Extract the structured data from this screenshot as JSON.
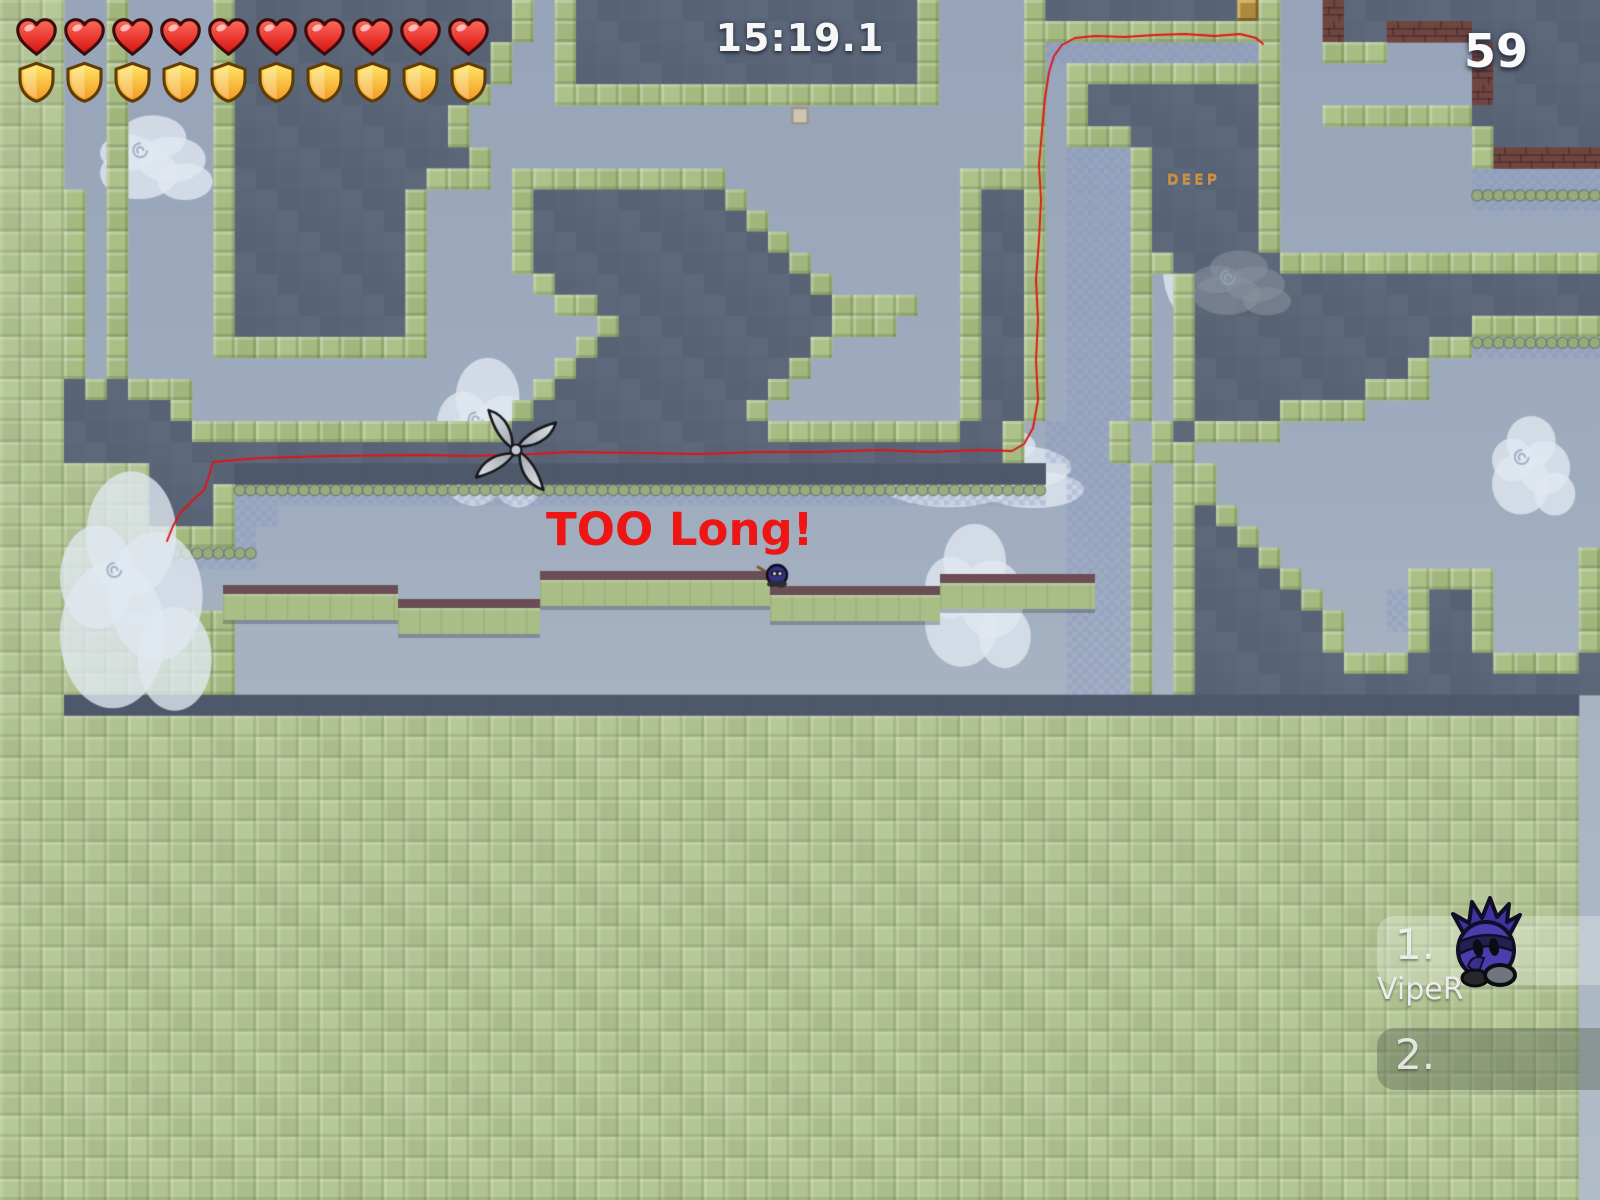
{
  "hud": {
    "timer": "15:19.1",
    "counter": "59",
    "hearts": 10,
    "shields": 10
  },
  "messages": {
    "too_long": "TOO Long!",
    "deep": "DEEP"
  },
  "leaderboard": {
    "entries": [
      {
        "rank": "1.",
        "name": "VipeR"
      },
      {
        "rank": "2.",
        "name": ""
      }
    ]
  },
  "colors": {
    "sky_top": "#97a4b9",
    "sky_bottom": "#b1bcc8",
    "slate": "#596476",
    "navy_band": "#4e586b",
    "green_wall": "#a7bc83",
    "green_field": "#b4c394",
    "freeze": "#8090c6",
    "brick": "#6f4540",
    "gold_tile": "#ab8a40",
    "race_line": "#e11414",
    "map_text_red": "#ee1515",
    "map_text_orange": "#cd9040"
  },
  "map": {
    "cols": 75,
    "rows": 57,
    "grid": [
      "GGG..S....SSSSSSSSSSSSSSS.SSSSSSSSSSSSSSSSSS....GSSSSSSSSSDG..BBBBBBBBBBBBB",
      "GGG..S....SSSSSSSSSSSSSSS.SSSSSSSSSSSSSSSSSS....GSSSSSSSSSSG..BBBBBBBBBBBBB",
      "GGG..S....SSSSSSSSSSSSSS..SSSSSSSSSSSSSSSSSS....GFFFFFFFFFFG..GGG....BBBBBB",
      "GGG..S....SSSSSSSSSSSSSS..SSSSSSSSSSSSSSSSSS....G.SSSSSSSSSS.........BBBBBB",
      "GGG..S....SSSSSSSSSSSSS...SSSSSSSSSSSSSSSSSS....G.SSSSSSSSSS.........BBBBBB",
      "GGG..S....SSSSSSSSSSSS...............w..........G.SSSSSSSSSS..GGGGGGGBBBBBB",
      "GGG..S....SSSSSSSSSSSS..........................G.SSSSSSSSSS.........GBBBBB",
      "GGG..S....SSSSSSSSSSSSS.........................G.FFFSSSSSSS.........GBBBBB",
      "GGG..S....SSSSSSSSSSSSS.SSSSSSSSSS...........SSSG.FFFSSSSSSS.........FFFFFF",
      "GGGS.S....SSSSSSSSSS....SSSSSSSSSSS..........SSSS.FFFSSSSSSS.........ffffff",
      "GGGS.S....SSSSSSSSSS....SSSSSSSSSSSS.........SSSS.FFFSSSSSSS...............",
      "GGGS.S....SSSSSSSSSS....SSSSSSSSSSSSS........SSSS.FFFSSSSSSS...............",
      "GGGS.S....SSSSSSSSSS....SSSSSSSSSSSSSS.......SSSS.FFFSSSSSSSSSSSSSSSSSSSSSS",
      "GGGS.S....SSSSSSSSSS.....SSSSSSSSSSSSSS......SSSS.FFFS.SSSSSSSSSSSSSSSSSSSS",
      "GGGS.S....SSSSSSSSSS......SSSSSSSSSSSSSSSSS..SSSS.FFFS.SSSSSSSSSSSSSSSSSSSS",
      "GGGS.S....SSSSSSSSSS........SSSSSSSSSSSSSS...SSSS.FFFS.SSSSSSSSSSSSSSSSSSSS",
      "GGGS.S....SSSSSSSSSS.......SSSSSSSSSSSS......SSSS.FFFS.SSSSSSSSSSSSSSffffff",
      "GGGS.S....................SSSSSSSSSSSS.......SSSS.FFFS.SSSSSSSSSSSS........",
      "GGGSSSSSS................SSSSSSSSSSSS........SSSS.FFFS.SSSSSSSSSSSS........",
      "GGGSSSSSS...............SSSSSSSSSSSS.........SSSS.FFFS.SSSSSSSSS...........",
      "GGGSSSSSSSSSSSSSSSSSSSSSSSSSSSSSSSSSSSSSSSSSSSSS.FFFS.SSSSSS..............",
      "GGGSSSSSSSSSSSSSSSSSSSSSSSSSSSSSSSSSSSSSSSSSSSSS.FFFS.SS..................",
      "GGGGGGGSSSSNNNNNNNNNNNNNNNNNNNNNNNNNNNNNNNNNNNNNN.FFFS.SS..................",
      "GGGGGGGSSSSffffffffffffffffffffffffffffffffffffff.FFFS.SS..................",
      "GGGGGGGSSSSFF.....................................FFFS.SSS.................",
      "GGGGGGGSSSSF......................................FFFS.SSSS................",
      "GGGGGGG.ffff......................................FFFS.SSSSS..............S",
      "GGGGGGG...........................................FFFS.SSSSSS.....SSSS....S",
      "GGGGGGG...........................................FFFS.SSSSSSS...FSSSS....S",
      "GGGGGGGGGGG.......................................FFFS.SSSSSSSS..FSSSS....S",
      "GGGGGGGGGGG.......................................FFFS.SSSSSSSS...SSSS....S",
      "GGGGGGGGGGG.......................................FFFS.SSSSSSSSSSSSSSSSSSSS",
      "GGGGGGGGGGG.......................................FFFS.SSSSSSSSSSSSSSSSSSSS",
      "GGGNNNNNNNNNNNNNNNNNNNNNNNNNNNNNNNNNNNNNNNNNNNNNNNNNNNNNNNNNNNNNNNNNNNNNNN",
      "GGGGGGGGGGGGGGGGGGGGGGGGGGGGGGGGGGGGGGGGGGGGGGGGGGGGGGGGGGGGGGGGGGGGGGGGGG",
      "GGGGGGGGGGGGGGGGGGGGGGGGGGGGGGGGGGGGGGGGGGGGGGGGGGGGGGGGGGGGGGGGGGGGGGGGGG",
      "GGGGGGGGGGGGGGGGGGGGGGGGGGGGGGGGGGGGGGGGGGGGGGGGGGGGGGGGGGGGGGGGGGGGGGGGGG",
      "GGGGGGGGGGGGGGGGGGGGGGGGGGGGGGGGGGGGGGGGGGGGGGGGGGGGGGGGGGGGGGGGGGGGGGGGGG",
      "GGGGGGGGGGGGGGGGGGGGGGGGGGGGGGGGGGGGGGGGGGGGGGGGGGGGGGGGGGGGGGGGGGGGGGGGGG",
      "GGGGGGGGGGGGGGGGGGGGGGGGGGGGGGGGGGGGGGGGGGGGGGGGGGGGGGGGGGGGGGGGGGGGGGGGGG",
      "GGGGGGGGGGGGGGGGGGGGGGGGGGGGGGGGGGGGGGGGGGGGGGGGGGGGGGGGGGGGGGGGGGGGGGGGGG",
      "GGGGGGGGGGGGGGGGGGGGGGGGGGGGGGGGGGGGGGGGGGGGGGGGGGGGGGGGGGGGGGGGGGGGGGGGGG",
      "GGGGGGGGGGGGGGGGGGGGGGGGGGGGGGGGGGGGGGGGGGGGGGGGGGGGGGGGGGGGGGGGGGGGGGGGGG",
      "GGGGGGGGGGGGGGGGGGGGGGGGGGGGGGGGGGGGGGGGGGGGGGGGGGGGGGGGGGGGGGGGGGGGGGGGGG",
      "GGGGGGGGGGGGGGGGGGGGGGGGGGGGGGGGGGGGGGGGGGGGGGGGGGGGGGGGGGGGGGGGGGGGGGGGGG",
      "GGGGGGGGGGGGGGGGGGGGGGGGGGGGGGGGGGGGGGGGGGGGGGGGGGGGGGGGGGGGGGGGGGGGGGGGGG",
      "GGGGGGGGGGGGGGGGGGGGGGGGGGGGGGGGGGGGGGGGGGGGGGGGGGGGGGGGGGGGGGGGGGGGGGGGGG",
      "GGGGGGGGGGGGGGGGGGGGGGGGGGGGGGGGGGGGGGGGGGGGGGGGGGGGGGGGGGGGGGGGGGGGGGGGGG",
      "GGGGGGGGGGGGGGGGGGGGGGGGGGGGGGGGGGGGGGGGGGGGGGGGGGGGGGGGGGGGGGGGGGGGGGGGGG",
      "GGGGGGGGGGGGGGGGGGGGGGGGGGGGGGGGGGGGGGGGGGGGGGGGGGGGGGGGGGGGGGGGGGGGGGGGGG",
      "GGGGGGGGGGGGGGGGGGGGGGGGGGGGGGGGGGGGGGGGGGGGGGGGGGGGGGGGGGGGGGGGGGGGGGGGGG",
      "GGGGGGGGGGGGGGGGGGGGGGGGGGGGGGGGGGGGGGGGGGGGGGGGGGGGGGGGGGGGGGGGGGGGGGGGGG",
      "GGGGGGGGGGGGGGGGGGGGGGGGGGGGGGGGGGGGGGGGGGGGGGGGGGGGGGGGGGGGGGGGGGGGGGGGGG",
      "GGGGGGGGGGGGGGGGGGGGGGGGGGGGGGGGGGGGGGGGGGGGGGGGGGGGGGGGGGGGGGGGGGGGGGGGGG",
      "GGGGGGGGGGGGGGGGGGGGGGGGGGGGGGGGGGGGGGGGGGGGGGGGGGGGGGGGGGGGGGGGGGGGGGGGGG",
      "GGGGGGGGGGGGGGGGGGGGGGGGGGGGGGGGGGGGGGGGGGGGGGGGGGGGGGGGGGGGGGGGGGGGGGGGGG",
      "GGGGGGGGGGGGGGGGGGGGGGGGGGGGGGGGGGGGGGGGGGGGGGGGGGGGGGGGGGGGGGGGGGGGGGGGGG"
    ],
    "platform_segments": [
      {
        "x": 223,
        "w": 175,
        "top": 585
      },
      {
        "x": 398,
        "w": 142,
        "top": 599
      },
      {
        "x": 540,
        "w": 230,
        "top": 571
      },
      {
        "x": 770,
        "w": 170,
        "top": 586
      },
      {
        "x": 940,
        "w": 155,
        "top": 574
      }
    ],
    "red_path": [
      [
        167,
        541
      ],
      [
        173,
        526
      ],
      [
        181,
        512
      ],
      [
        194,
        499
      ],
      [
        204,
        490
      ],
      [
        209,
        476
      ],
      [
        213,
        462
      ],
      [
        260,
        458
      ],
      [
        330,
        456
      ],
      [
        420,
        455
      ],
      [
        470,
        456
      ],
      [
        515,
        455
      ],
      [
        570,
        452
      ],
      [
        640,
        453
      ],
      [
        700,
        454
      ],
      [
        760,
        452
      ],
      [
        820,
        452
      ],
      [
        880,
        450
      ],
      [
        930,
        452
      ],
      [
        980,
        450
      ],
      [
        1012,
        451
      ],
      [
        1024,
        444
      ],
      [
        1033,
        428
      ],
      [
        1038,
        400
      ],
      [
        1036,
        360
      ],
      [
        1038,
        320
      ],
      [
        1036,
        280
      ],
      [
        1039,
        240
      ],
      [
        1041,
        200
      ],
      [
        1039,
        165
      ],
      [
        1042,
        130
      ],
      [
        1045,
        98
      ],
      [
        1049,
        72
      ],
      [
        1054,
        56
      ],
      [
        1062,
        45
      ],
      [
        1075,
        38
      ],
      [
        1095,
        36
      ],
      [
        1125,
        37
      ],
      [
        1155,
        35
      ],
      [
        1185,
        34
      ],
      [
        1215,
        36
      ],
      [
        1240,
        34
      ],
      [
        1256,
        38
      ],
      [
        1263,
        44
      ]
    ],
    "clouds": [
      {
        "x": 100,
        "y": 112,
        "w": 115,
        "h": 85,
        "tint": "white",
        "layer": "back",
        "swirl": true
      },
      {
        "x": 437,
        "y": 352,
        "w": 110,
        "h": 150,
        "tint": "white",
        "layer": "back",
        "swirl": true
      },
      {
        "x": 878,
        "y": 420,
        "w": 210,
        "h": 85,
        "tint": "white",
        "layer": "back",
        "swirl": false
      },
      {
        "x": 925,
        "y": 518,
        "w": 108,
        "h": 145,
        "tint": "white",
        "layer": "back",
        "swirl": true
      },
      {
        "x": 1163,
        "y": 148,
        "w": 105,
        "h": 170,
        "tint": "white",
        "layer": "back",
        "swirl": false
      },
      {
        "x": 60,
        "y": 462,
        "w": 155,
        "h": 240,
        "tint": "white",
        "layer": "front",
        "swirl": true
      },
      {
        "x": 1193,
        "y": 248,
        "w": 100,
        "h": 65,
        "tint": "gray",
        "layer": "front",
        "swirl": true
      },
      {
        "x": 1492,
        "y": 412,
        "w": 85,
        "h": 100,
        "tint": "white",
        "layer": "front",
        "swirl": true
      }
    ],
    "shuriken": {
      "x": 516,
      "y": 450,
      "r": 40
    },
    "player": {
      "x": 777,
      "y": 575
    }
  }
}
